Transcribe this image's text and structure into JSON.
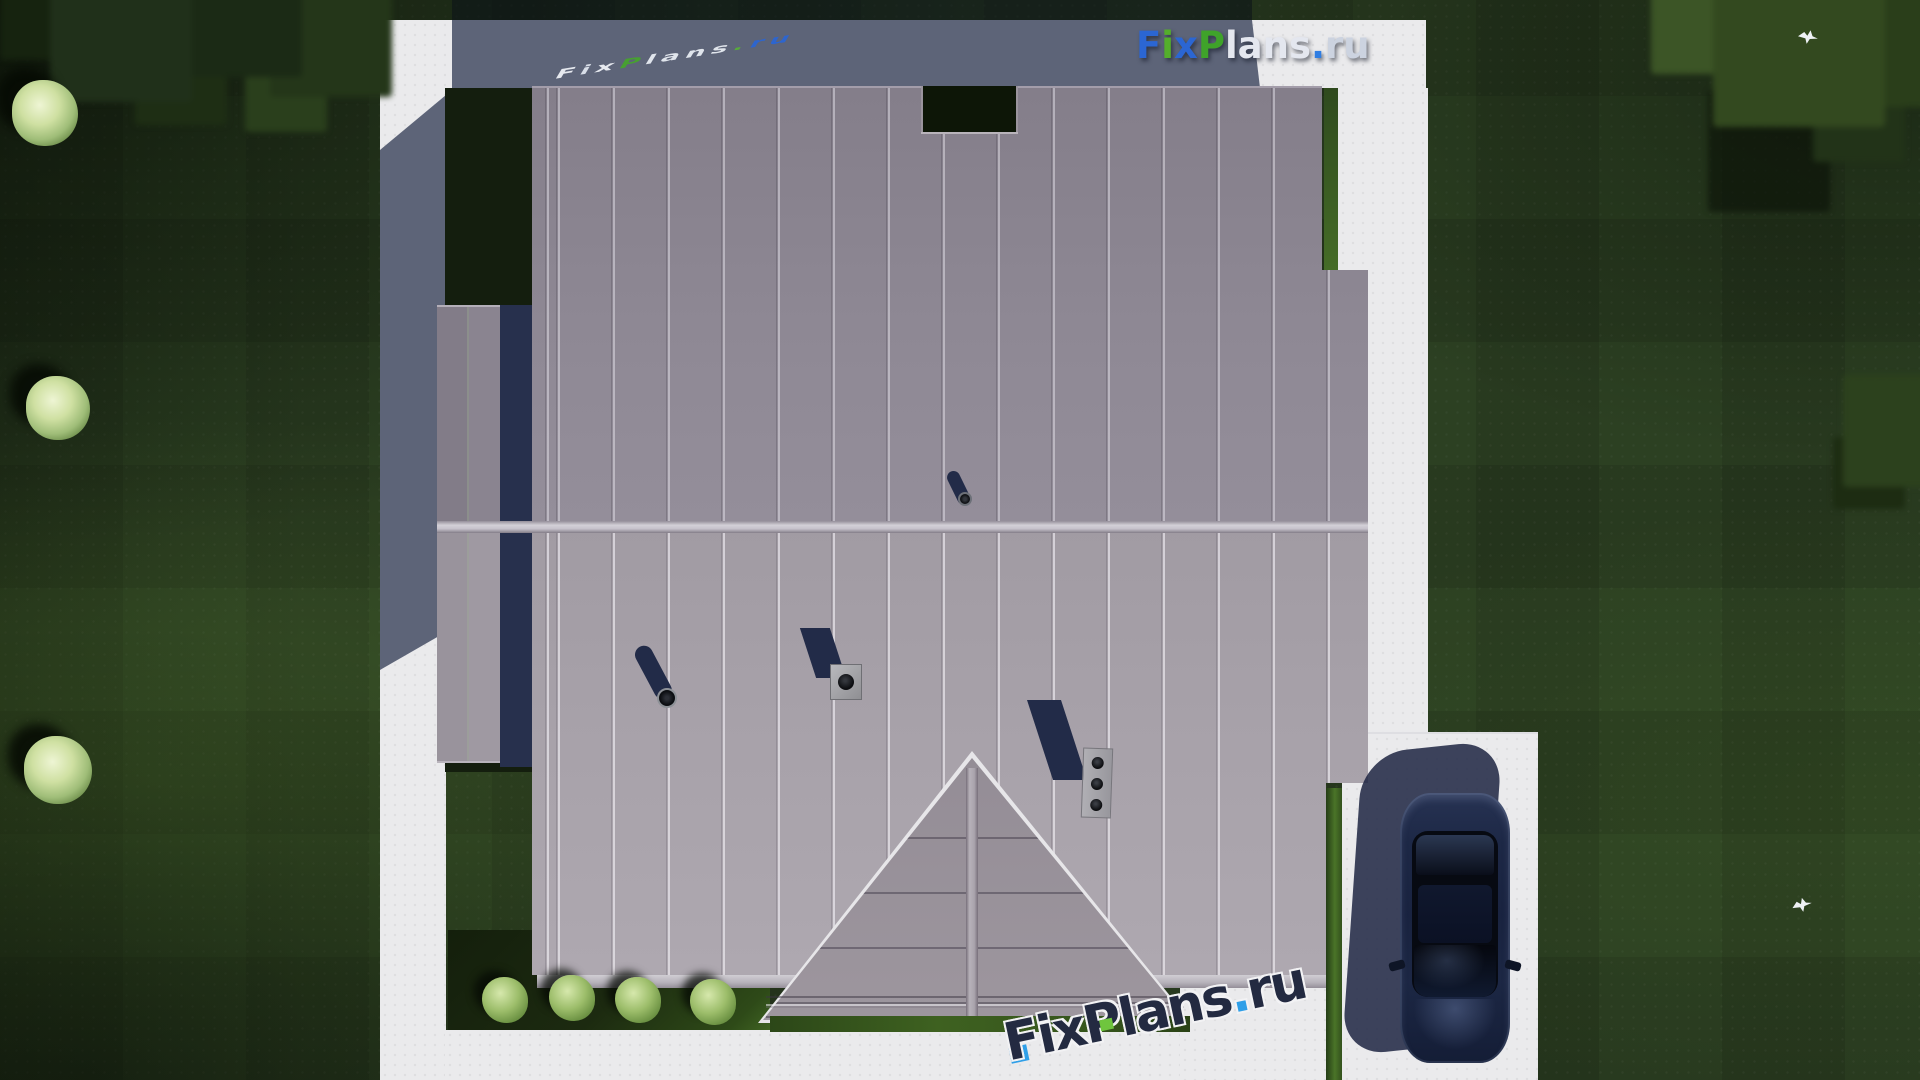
{
  "brand": {
    "name": "FixPlans.ru",
    "segments": [
      "F",
      "i",
      "x",
      "P",
      "lans",
      ".",
      "ru"
    ],
    "variants": {
      "primary": [
        "#2b66d3",
        "#54ae2b",
        "#2b66d3",
        "#3fa32a",
        "#e4e7ef",
        "#2f7de2",
        "#ccd3e0"
      ],
      "light": [
        "#eef1f6",
        "#dfe5ee",
        "#eef1f6",
        "#46a42e",
        "#e8ecf3",
        "#57b335",
        "#2b66d3"
      ],
      "dark": [
        "#232a41",
        "#232a41",
        "#232a41",
        "#232a41",
        "#232a41",
        "#2f9fe8",
        "#232a41"
      ]
    }
  },
  "scene": {
    "type": "aerial-3d-render",
    "subject": "Top-down roof plan of a detached house with surrounding lawn, concrete walkway, driveway and parked car",
    "objects": [
      "lawn with mowing pattern",
      "trees",
      "ornamental shrubs",
      "concrete walkway frame",
      "driveway",
      "parked dark-blue car",
      "main roof north slope",
      "main roof south slope",
      "side roof extension",
      "porch gable roof",
      "roof opening",
      "three-flue chimney",
      "roof vent pipes",
      "box roof vent",
      "garden bed with four bushes",
      "two flying birds",
      "house cast shadow"
    ],
    "colors": {
      "lawn": "#2c4022",
      "lawn_shadow": "#141e0e",
      "walkway": "#eaeaec",
      "walkway_shadow": "#5d6478",
      "roof_north_slope": "#8b8591",
      "roof_south_slope": "#a8a2aa",
      "roof_gable": "#9a939c",
      "roof_ridge": "#d3d0d7",
      "cast_shadow": "#222b48",
      "car_paint": "#1d2846",
      "bush_foliage": "#9cbd6a",
      "brand_blue": "#2b66d3",
      "brand_green": "#3fa32a"
    }
  }
}
